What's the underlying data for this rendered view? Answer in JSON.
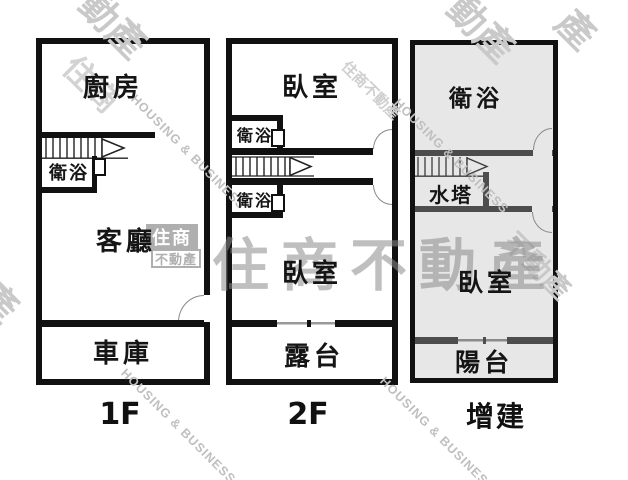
{
  "plans": [
    {
      "id": "floor-1",
      "floor_label": "1F",
      "rooms": {
        "kitchen": "廚房",
        "bath": "衛浴",
        "living": "客廳",
        "garage": "車庫"
      }
    },
    {
      "id": "floor-2",
      "floor_label": "2F",
      "rooms": {
        "bedroom_top": "臥室",
        "bath_upper": "衛浴",
        "bath_lower": "衛浴",
        "bedroom_bottom": "臥室",
        "terrace": "露台"
      }
    },
    {
      "id": "annex",
      "floor_label": "增建",
      "rooms": {
        "bath": "衛浴",
        "water_tank": "水塔",
        "bedroom": "臥室",
        "balcony": "陽台"
      }
    }
  ],
  "watermarks": {
    "center_text": "住商不動產",
    "diagonal_en": "HOUSING & BUSINESS",
    "logo": {
      "top": "住商",
      "bottom": "不動產"
    },
    "fragment_a": "動產",
    "fragment_b": "住商",
    "fragment_c": "產",
    "fragment_d": "不動產",
    "fragment_e": "住商不動產"
  },
  "colors": {
    "wall": "#111111",
    "annex_wall": "#4d4d4d",
    "annex_background": "#e7e7e7",
    "watermark_gray": "#9a9a9a",
    "background": "#ffffff"
  }
}
